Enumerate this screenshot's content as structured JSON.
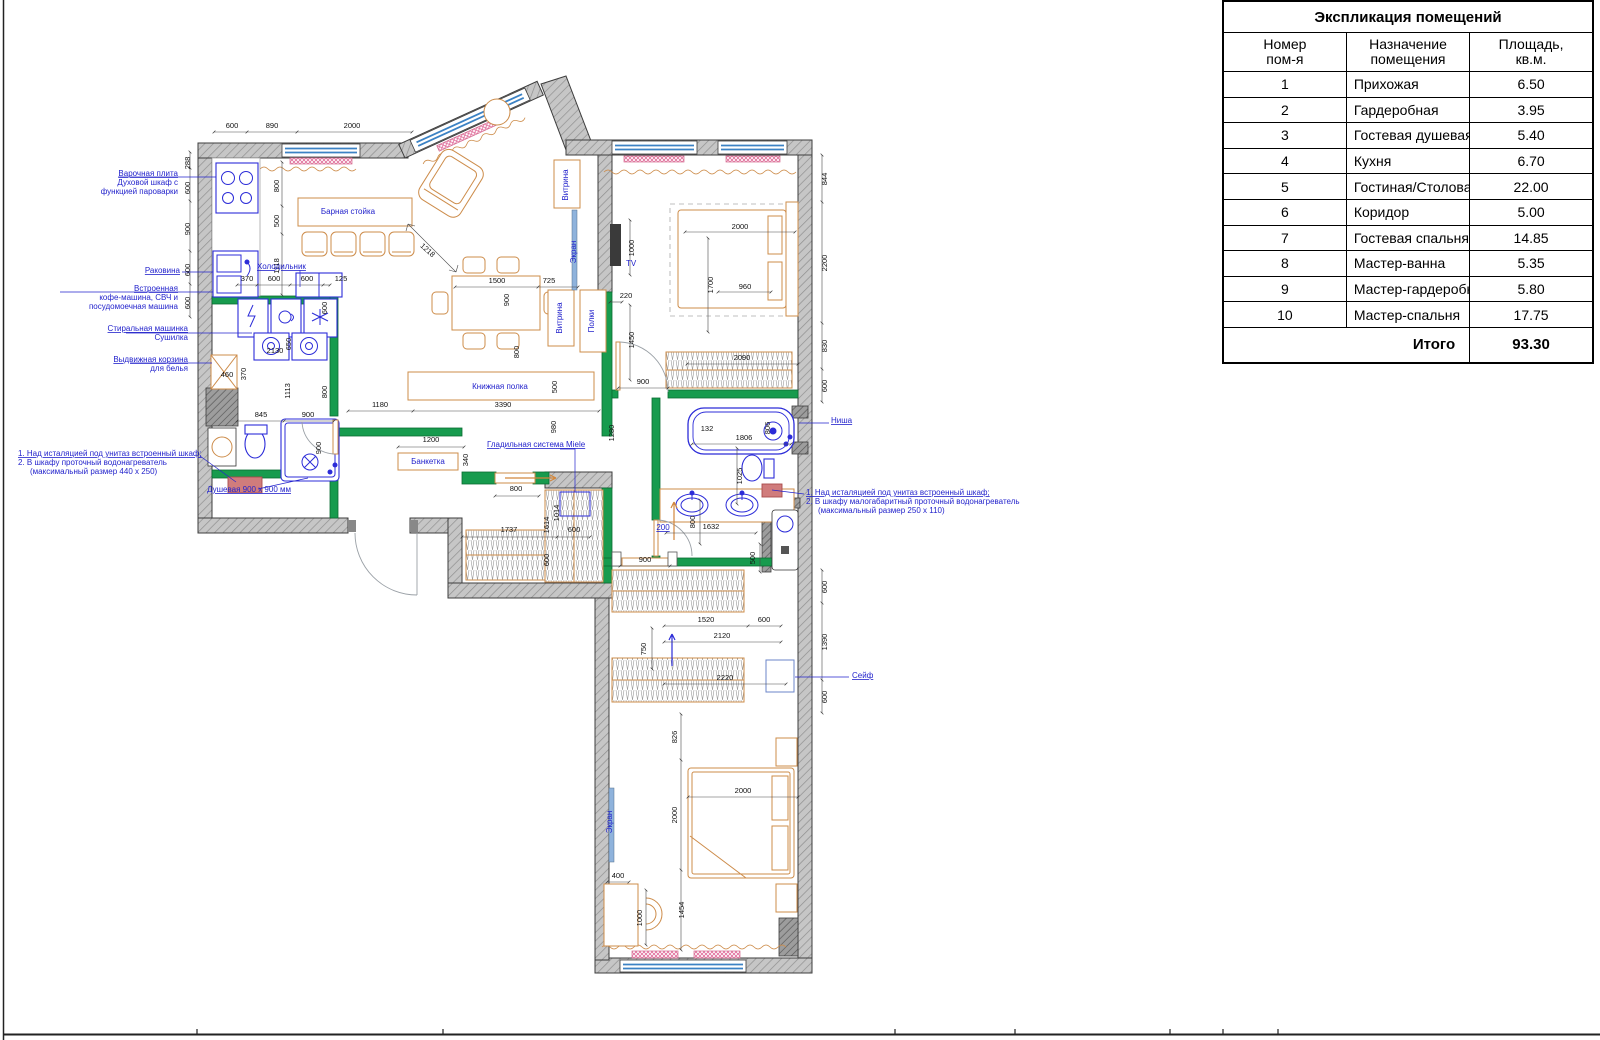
{
  "table": {
    "title": "Экспликация помещений",
    "col_headers": {
      "num": "Номер\nпом-я",
      "name": "Назначение помещения",
      "area": "Площадь,\nкв.м."
    },
    "rows": [
      {
        "num": "1",
        "name": "Прихожая",
        "area": "6.50"
      },
      {
        "num": "2",
        "name": "Гардеробная",
        "area": "3.95"
      },
      {
        "num": "3",
        "name": "Гостевая душевая",
        "area": "5.40"
      },
      {
        "num": "4",
        "name": "Кухня",
        "area": "6.70"
      },
      {
        "num": "5",
        "name": "Гостиная/Столовая",
        "area": "22.00"
      },
      {
        "num": "6",
        "name": "Коридор",
        "area": "5.00"
      },
      {
        "num": "7",
        "name": "Гостевая спальня/Детская",
        "area": "14.85"
      },
      {
        "num": "8",
        "name": "Мастер-ванна",
        "area": "5.35"
      },
      {
        "num": "9",
        "name": "Мастер-гардеробная",
        "area": "5.80"
      },
      {
        "num": "10",
        "name": "Мастер-спальня",
        "area": "17.75"
      }
    ],
    "total_label": "Итого",
    "total_value": "93.30"
  },
  "plan": {
    "colors": {
      "partition_green": "#179b4e",
      "furniture_orange": "#cd8c4a",
      "fixture_blue": "#2c2cd8",
      "annotation_blue": "#2323cc",
      "window_blue": "#3c82c4",
      "radiator_pink": "#d4688e",
      "wall_gray": "#c2c2c2"
    },
    "texts": [
      {
        "t": "600",
        "x": 232,
        "y": 128,
        "k": "d"
      },
      {
        "t": "890",
        "x": 272,
        "y": 128,
        "k": "d"
      },
      {
        "t": "2000",
        "x": 352,
        "y": 128,
        "k": "d"
      },
      {
        "t": "1218",
        "x": 426,
        "y": 252,
        "k": "d",
        "r": 42
      },
      {
        "t": "288",
        "x": 190,
        "y": 163,
        "k": "d",
        "r": -90
      },
      {
        "t": "600",
        "x": 190,
        "y": 188,
        "k": "d",
        "r": -90
      },
      {
        "t": "900",
        "x": 190,
        "y": 229,
        "k": "d",
        "r": -90
      },
      {
        "t": "600",
        "x": 190,
        "y": 270,
        "k": "d",
        "r": -90
      },
      {
        "t": "600",
        "x": 190,
        "y": 303,
        "k": "d",
        "r": -90
      },
      {
        "t": "800",
        "x": 279,
        "y": 186,
        "k": "d",
        "r": -90
      },
      {
        "t": "500",
        "x": 279,
        "y": 221,
        "k": "d",
        "r": -90
      },
      {
        "t": "1118",
        "x": 279,
        "y": 266,
        "k": "d",
        "r": -90
      },
      {
        "t": "370",
        "x": 247,
        "y": 281,
        "k": "d"
      },
      {
        "t": "600",
        "x": 274,
        "y": 281,
        "k": "d"
      },
      {
        "t": "600",
        "x": 307,
        "y": 281,
        "k": "d"
      },
      {
        "t": "125",
        "x": 341,
        "y": 281,
        "k": "d"
      },
      {
        "t": "600",
        "x": 327,
        "y": 308,
        "k": "d",
        "r": -90
      },
      {
        "t": "2130",
        "x": 275,
        "y": 353,
        "k": "d"
      },
      {
        "t": "650",
        "x": 291,
        "y": 344,
        "k": "d",
        "r": -90
      },
      {
        "t": "370",
        "x": 246,
        "y": 374,
        "k": "d",
        "r": -90
      },
      {
        "t": "460",
        "x": 227,
        "y": 377,
        "k": "d"
      },
      {
        "t": "1113",
        "x": 290,
        "y": 391,
        "k": "d",
        "r": -90
      },
      {
        "t": "800",
        "x": 327,
        "y": 392,
        "k": "d",
        "r": -90
      },
      {
        "t": "845",
        "x": 261,
        "y": 417,
        "k": "d"
      },
      {
        "t": "900",
        "x": 308,
        "y": 417,
        "k": "d"
      },
      {
        "t": "900",
        "x": 321,
        "y": 448,
        "k": "d",
        "r": -90
      },
      {
        "t": "1180",
        "x": 380,
        "y": 407,
        "k": "d"
      },
      {
        "t": "3390",
        "x": 503,
        "y": 407,
        "k": "d"
      },
      {
        "t": "500",
        "x": 557,
        "y": 387,
        "k": "d",
        "r": -90
      },
      {
        "t": "980",
        "x": 556,
        "y": 427,
        "k": "d",
        "r": -90
      },
      {
        "t": "1280",
        "x": 614,
        "y": 433,
        "k": "d",
        "r": -90
      },
      {
        "t": "1500",
        "x": 497,
        "y": 283,
        "k": "d"
      },
      {
        "t": "725",
        "x": 549,
        "y": 283,
        "k": "d"
      },
      {
        "t": "900",
        "x": 509,
        "y": 300,
        "k": "d",
        "r": -90
      },
      {
        "t": "800",
        "x": 519,
        "y": 352,
        "k": "d",
        "r": -90
      },
      {
        "t": "1200",
        "x": 431,
        "y": 442,
        "k": "d"
      },
      {
        "t": "340",
        "x": 468,
        "y": 460,
        "k": "d",
        "r": -90
      },
      {
        "t": "800",
        "x": 516,
        "y": 491,
        "k": "d"
      },
      {
        "t": "1737",
        "x": 509,
        "y": 532,
        "k": "d"
      },
      {
        "t": "1614",
        "x": 549,
        "y": 525,
        "k": "d",
        "r": -90
      },
      {
        "t": "1014",
        "x": 559,
        "y": 513,
        "k": "d",
        "r": -90
      },
      {
        "t": "600",
        "x": 574,
        "y": 532,
        "k": "d"
      },
      {
        "t": "600",
        "x": 549,
        "y": 560,
        "k": "d",
        "r": -90
      },
      {
        "t": "900",
        "x": 643,
        "y": 384,
        "k": "d"
      },
      {
        "t": "900",
        "x": 645,
        "y": 562,
        "k": "d"
      },
      {
        "t": "1632",
        "x": 711,
        "y": 529,
        "k": "d"
      },
      {
        "t": "500",
        "x": 755,
        "y": 558,
        "k": "d",
        "r": -90
      },
      {
        "t": "800",
        "x": 695,
        "y": 522,
        "k": "d",
        "r": -90
      },
      {
        "t": "1025",
        "x": 742,
        "y": 476,
        "k": "d",
        "r": -90
      },
      {
        "t": "132",
        "x": 707,
        "y": 431,
        "k": "d"
      },
      {
        "t": "1806",
        "x": 744,
        "y": 440,
        "k": "d"
      },
      {
        "t": "806",
        "x": 770,
        "y": 428,
        "k": "d",
        "r": -90
      },
      {
        "t": "2000",
        "x": 740,
        "y": 229,
        "k": "d"
      },
      {
        "t": "1700",
        "x": 713,
        "y": 285,
        "k": "d",
        "r": -90
      },
      {
        "t": "960",
        "x": 745,
        "y": 289,
        "k": "d"
      },
      {
        "t": "2090",
        "x": 742,
        "y": 360,
        "k": "d"
      },
      {
        "t": "220",
        "x": 626,
        "y": 298,
        "k": "d"
      },
      {
        "t": "1450",
        "x": 634,
        "y": 340,
        "k": "d",
        "r": -90
      },
      {
        "t": "1000",
        "x": 634,
        "y": 248,
        "k": "d",
        "r": -90
      },
      {
        "t": "844",
        "x": 827,
        "y": 179,
        "k": "d",
        "r": -90
      },
      {
        "t": "2200",
        "x": 827,
        "y": 263,
        "k": "d",
        "r": -90
      },
      {
        "t": "830",
        "x": 827,
        "y": 346,
        "k": "d",
        "r": -90
      },
      {
        "t": "600",
        "x": 827,
        "y": 386,
        "k": "d",
        "r": -90
      },
      {
        "t": "600",
        "x": 827,
        "y": 587,
        "k": "d",
        "r": -90
      },
      {
        "t": "1390",
        "x": 827,
        "y": 642,
        "k": "d",
        "r": -90
      },
      {
        "t": "600",
        "x": 827,
        "y": 697,
        "k": "d",
        "r": -90
      },
      {
        "t": "1520",
        "x": 706,
        "y": 622,
        "k": "d"
      },
      {
        "t": "600",
        "x": 764,
        "y": 622,
        "k": "d"
      },
      {
        "t": "2120",
        "x": 722,
        "y": 638,
        "k": "d"
      },
      {
        "t": "2220",
        "x": 725,
        "y": 680,
        "k": "d"
      },
      {
        "t": "750",
        "x": 646,
        "y": 649,
        "k": "d",
        "r": -90
      },
      {
        "t": "826",
        "x": 677,
        "y": 737,
        "k": "d",
        "r": -90
      },
      {
        "t": "2000",
        "x": 743,
        "y": 793,
        "k": "d"
      },
      {
        "t": "2000",
        "x": 677,
        "y": 815,
        "k": "d",
        "r": -90
      },
      {
        "t": "400",
        "x": 618,
        "y": 878,
        "k": "d"
      },
      {
        "t": "1000",
        "x": 642,
        "y": 918,
        "k": "d",
        "r": -90
      },
      {
        "t": "1454",
        "x": 684,
        "y": 910,
        "k": "d",
        "r": -90
      },
      {
        "t": "Варочная плита",
        "x": 178,
        "y": 176,
        "k": "a",
        "a": "e",
        "u": 1
      },
      {
        "t": "Духовой шкаф с",
        "x": 178,
        "y": 185,
        "k": "a",
        "a": "e"
      },
      {
        "t": "функцией пароварки",
        "x": 178,
        "y": 194,
        "k": "a",
        "a": "e"
      },
      {
        "t": "Раковина",
        "x": 180,
        "y": 273,
        "k": "a",
        "a": "e",
        "u": 1
      },
      {
        "t": "Встроенная",
        "x": 178,
        "y": 291,
        "k": "a",
        "a": "e",
        "u": 1
      },
      {
        "t": "кофе-машина, СВЧ и",
        "x": 178,
        "y": 300,
        "k": "a",
        "a": "e"
      },
      {
        "t": "посудомоечная машина",
        "x": 178,
        "y": 309,
        "k": "a",
        "a": "e"
      },
      {
        "t": "Стиральная машинка",
        "x": 188,
        "y": 331,
        "k": "a",
        "a": "e",
        "u": 1
      },
      {
        "t": "Сушилка",
        "x": 188,
        "y": 340,
        "k": "a",
        "a": "e"
      },
      {
        "t": "Выдвижная корзина",
        "x": 188,
        "y": 362,
        "k": "a",
        "a": "e",
        "u": 1
      },
      {
        "t": "для белья",
        "x": 188,
        "y": 371,
        "k": "a",
        "a": "e"
      },
      {
        "t": "1.  Над исталяцией под унитаз встроенный шкаф;",
        "x": 18,
        "y": 456,
        "k": "a",
        "a": "s",
        "u": 1
      },
      {
        "t": "2.  В шкафу проточный водонагреватель",
        "x": 18,
        "y": 465,
        "k": "a",
        "a": "s"
      },
      {
        "t": "(максимальный размер 440 х 250)",
        "x": 30,
        "y": 474,
        "k": "a",
        "a": "s"
      },
      {
        "t": "Душевая 900 х 900 мм",
        "x": 207,
        "y": 492,
        "k": "a",
        "a": "s",
        "u": 1
      },
      {
        "t": "Холодильник",
        "x": 257,
        "y": 269,
        "k": "a",
        "a": "s",
        "u": 1
      },
      {
        "t": "Барная стойка",
        "x": 348,
        "y": 214,
        "k": "a"
      },
      {
        "t": "Книжная полка",
        "x": 500,
        "y": 389,
        "k": "a"
      },
      {
        "t": "Банкетка",
        "x": 428,
        "y": 464,
        "k": "a",
        "fs": 6.5
      },
      {
        "t": "Гладильная система Miele",
        "x": 487,
        "y": 447,
        "k": "a",
        "a": "s",
        "u": 1
      },
      {
        "t": "TV",
        "x": 626,
        "y": 266,
        "k": "a",
        "a": "s",
        "fs": 9
      },
      {
        "t": "200",
        "x": 663,
        "y": 530,
        "k": "a",
        "u": 1
      },
      {
        "t": "Ниша",
        "x": 831,
        "y": 423,
        "k": "a",
        "a": "s",
        "u": 1
      },
      {
        "t": "1.  Над исталяцией под унитаз встроенный шкаф;",
        "x": 806,
        "y": 495,
        "k": "a",
        "a": "s",
        "u": 1
      },
      {
        "t": "2.  В шкафу малогабаритный проточный водонагреватель",
        "x": 806,
        "y": 504,
        "k": "a",
        "a": "s"
      },
      {
        "t": "(максимальный размер 250 х 110)",
        "x": 818,
        "y": 513,
        "k": "a",
        "a": "s"
      },
      {
        "t": "Сейф",
        "x": 852,
        "y": 678,
        "k": "a",
        "a": "s",
        "u": 1
      },
      {
        "t": "Экран",
        "x": 576,
        "y": 252,
        "k": "a",
        "r": -90
      },
      {
        "t": "Витрина",
        "x": 568,
        "y": 185,
        "k": "a",
        "r": -90
      },
      {
        "t": "Витрина",
        "x": 562,
        "y": 318,
        "k": "a",
        "r": -90
      },
      {
        "t": "Полки",
        "x": 594,
        "y": 321,
        "k": "a",
        "r": -90
      },
      {
        "t": "Экран",
        "x": 612,
        "y": 822,
        "k": "a",
        "r": -90
      }
    ]
  }
}
